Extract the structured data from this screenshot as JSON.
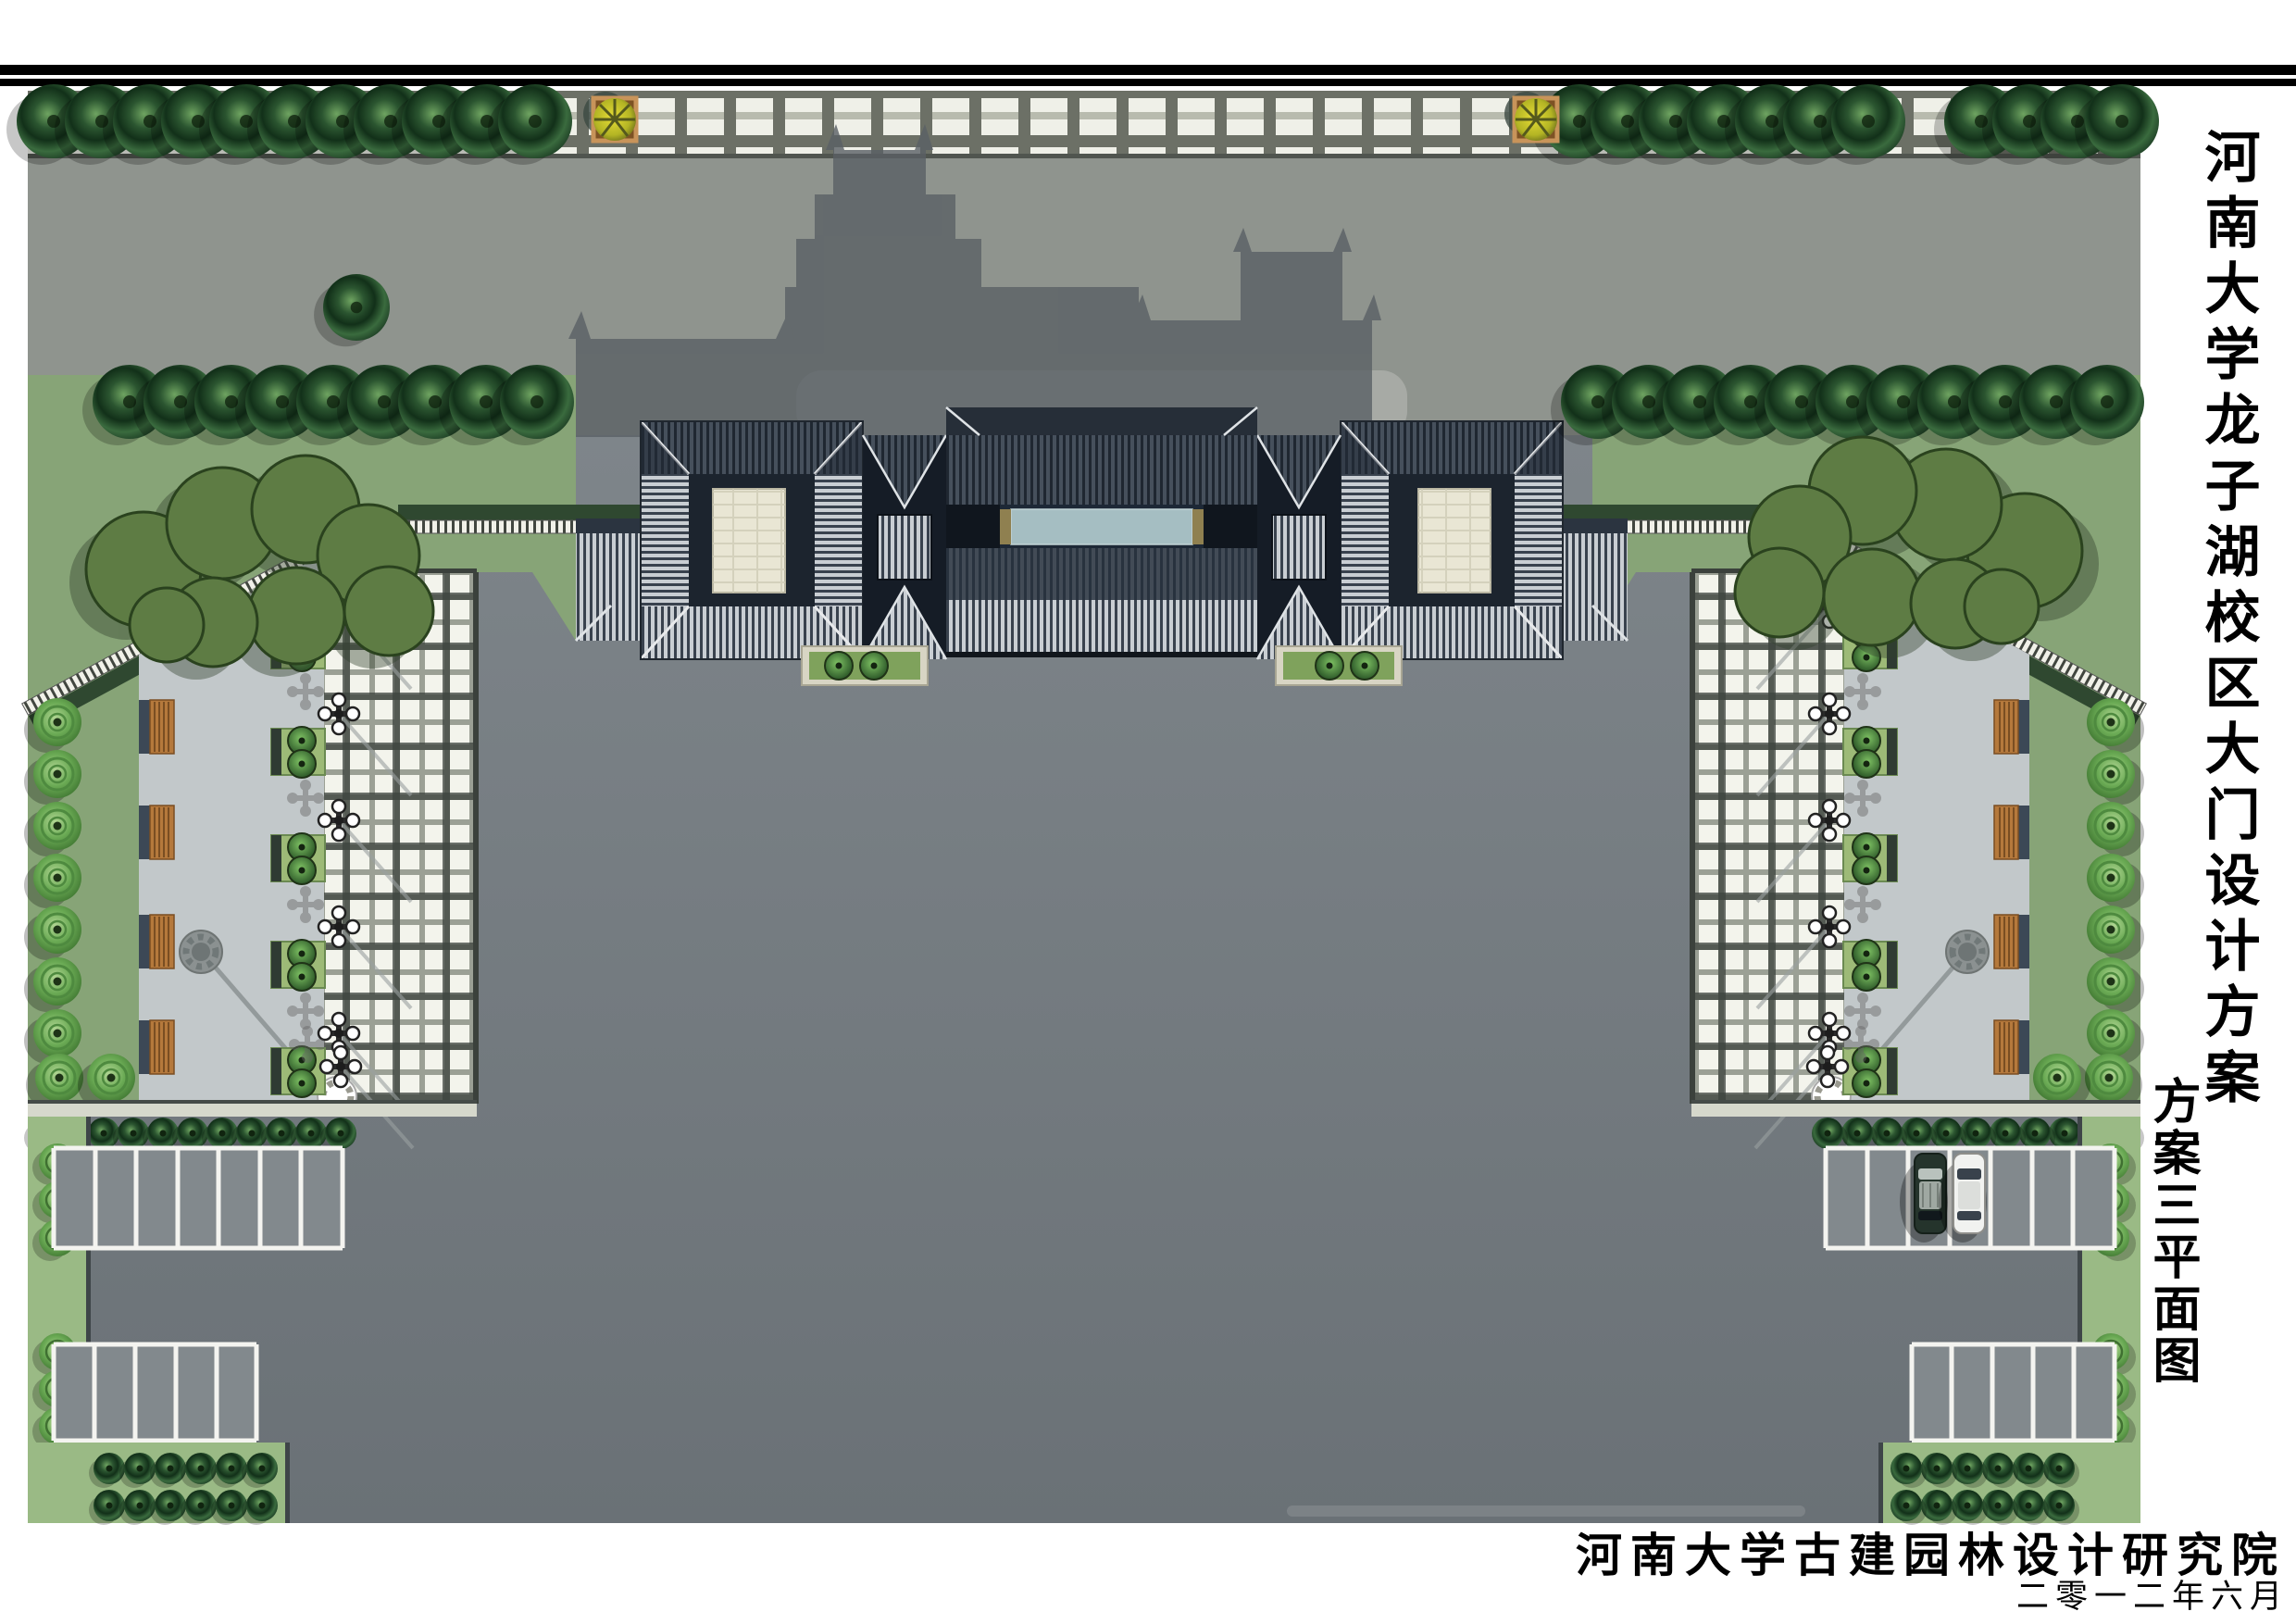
{
  "titles": {
    "main_vertical": "河南大学龙子湖校区大门设计方案",
    "scheme_vertical": "方案三平面图",
    "institute": "河南大学古建园林设计研究院",
    "date": "二零一二年六月"
  },
  "colors": {
    "frame": "#000000",
    "road": "#8f948e",
    "plaza_top": "#7e858a",
    "plaza_bottom": "#6a7176",
    "lawn": "#87a477",
    "lawn_light": "#9aba85",
    "paving_light": "#eff0e8",
    "grid_line": "#6c7066",
    "aisle_paving": "#c2c8ca",
    "roof_light": "#c9ced3",
    "roof_dark": "#39424e",
    "pool": "#a5bec2",
    "courtyard": "#e9e6d4",
    "hedge": "#2f4830",
    "tree_dark": "#2d4a2c",
    "tree_ring": "#5d9b4c",
    "bench_wood": "#b5793c",
    "gate_shadow": "#5a6065",
    "planter_orange": "#b9854e",
    "foliage_yellow": "#d8cf2e",
    "car_white": "#f1f2f0",
    "car_dark": "#25342c"
  }
}
